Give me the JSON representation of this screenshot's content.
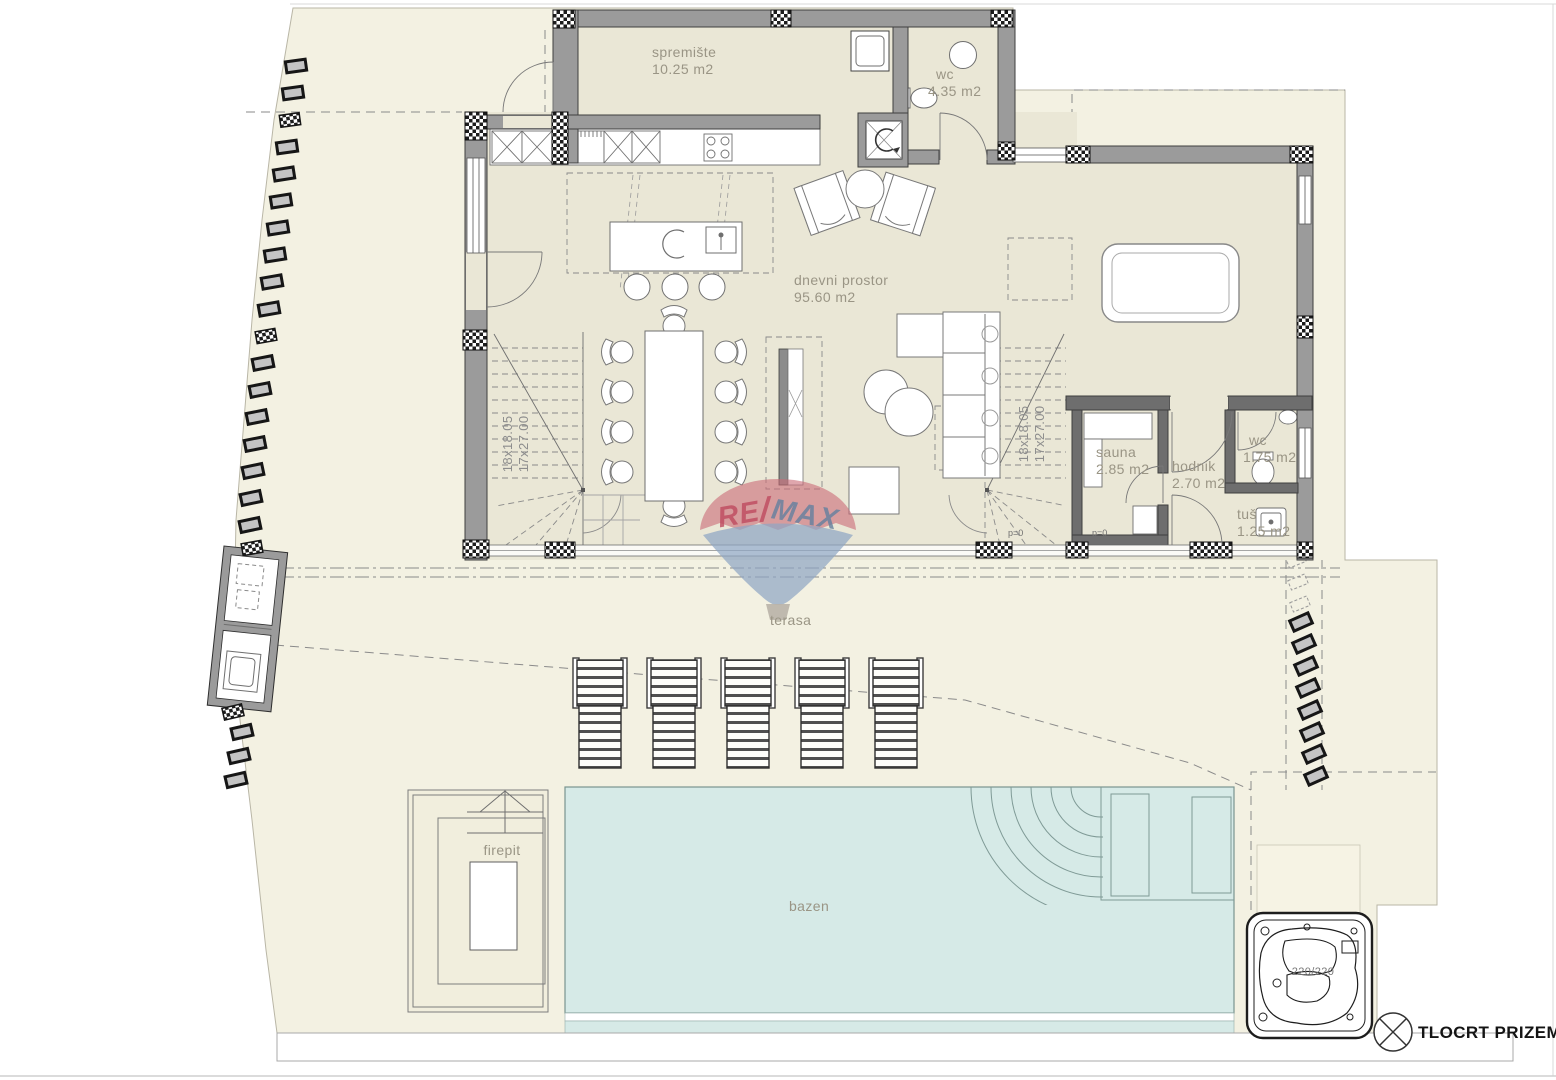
{
  "title_block": {
    "title": "TLOCRT PRIZEMLJA"
  },
  "watermark": {
    "re": "RE",
    "slash": "/",
    "max": "MAX"
  },
  "rooms": {
    "spremiste": {
      "name": "spremište",
      "area": "10.25 m2"
    },
    "wc_top": {
      "name": "wc",
      "area": "4.35 m2"
    },
    "dnevni": {
      "name": "dnevni prostor",
      "area": "95.60 m2"
    },
    "sauna": {
      "name": "sauna",
      "area": "2.85 m2"
    },
    "hodnik": {
      "name": "hodnik",
      "area": "2.70 m2"
    },
    "wc_small": {
      "name": "wc",
      "area": "1.75 m2"
    },
    "tus": {
      "name": "tuš",
      "area": "1.25 m2"
    }
  },
  "outdoor": {
    "terasa": "terasa",
    "firepit": "firepit",
    "bazen": "bazen"
  },
  "stairs": {
    "line1": "18x18.05",
    "line2": "17x27.00"
  },
  "markers": {
    "level_zero": "p=0",
    "hot_tub_size": "220/220"
  },
  "colors": {
    "wall": "#9b9b9b",
    "floor": "#eae7d6",
    "terrain": "#f3f1e2",
    "pool": "#d6eae7",
    "logo_red": "#bf4a5f",
    "logo_blue": "#64809f"
  }
}
